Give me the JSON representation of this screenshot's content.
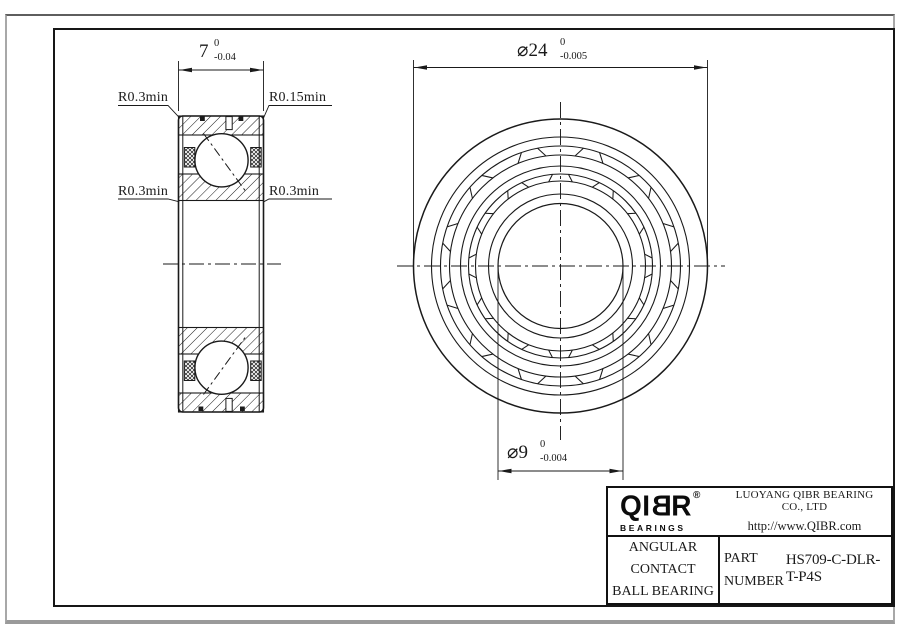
{
  "drawing": {
    "left_view": {
      "dim_width": {
        "value": "7",
        "sup": "0",
        "sub": "-0.04"
      },
      "labels": {
        "top_left": "R0.3min",
        "top_right": "R0.15min",
        "mid_left": "R0.3min",
        "mid_right": "R0.3min"
      }
    },
    "front_view": {
      "dim_outer_diameter": {
        "value": "⌀24",
        "sup": "0",
        "sub": "-0.005"
      },
      "dim_bore_diameter": {
        "value": "⌀9",
        "sup": "0",
        "sub": "-0.004"
      }
    }
  },
  "title_block": {
    "logo": {
      "prefix": "QI",
      "mirrored_letter": "B",
      "suffix": "R",
      "registered": "®",
      "subtitle": "BEARINGS"
    },
    "company_name": "LUOYANG QIBR BEARING CO., LTD",
    "website": "http://www.QIBR.com",
    "product_type_line1": "ANGULAR CONTACT",
    "product_type_line2": "BALL BEARING",
    "part_label_line1": "PART",
    "part_label_line2": "NUMBER",
    "part_number": "HS709-C-DLR-T-P4S"
  },
  "colors": {
    "line": "#1a1a1a",
    "paper": "#ffffff",
    "frame": "#161616",
    "outer_border": "#9a9a9a"
  }
}
